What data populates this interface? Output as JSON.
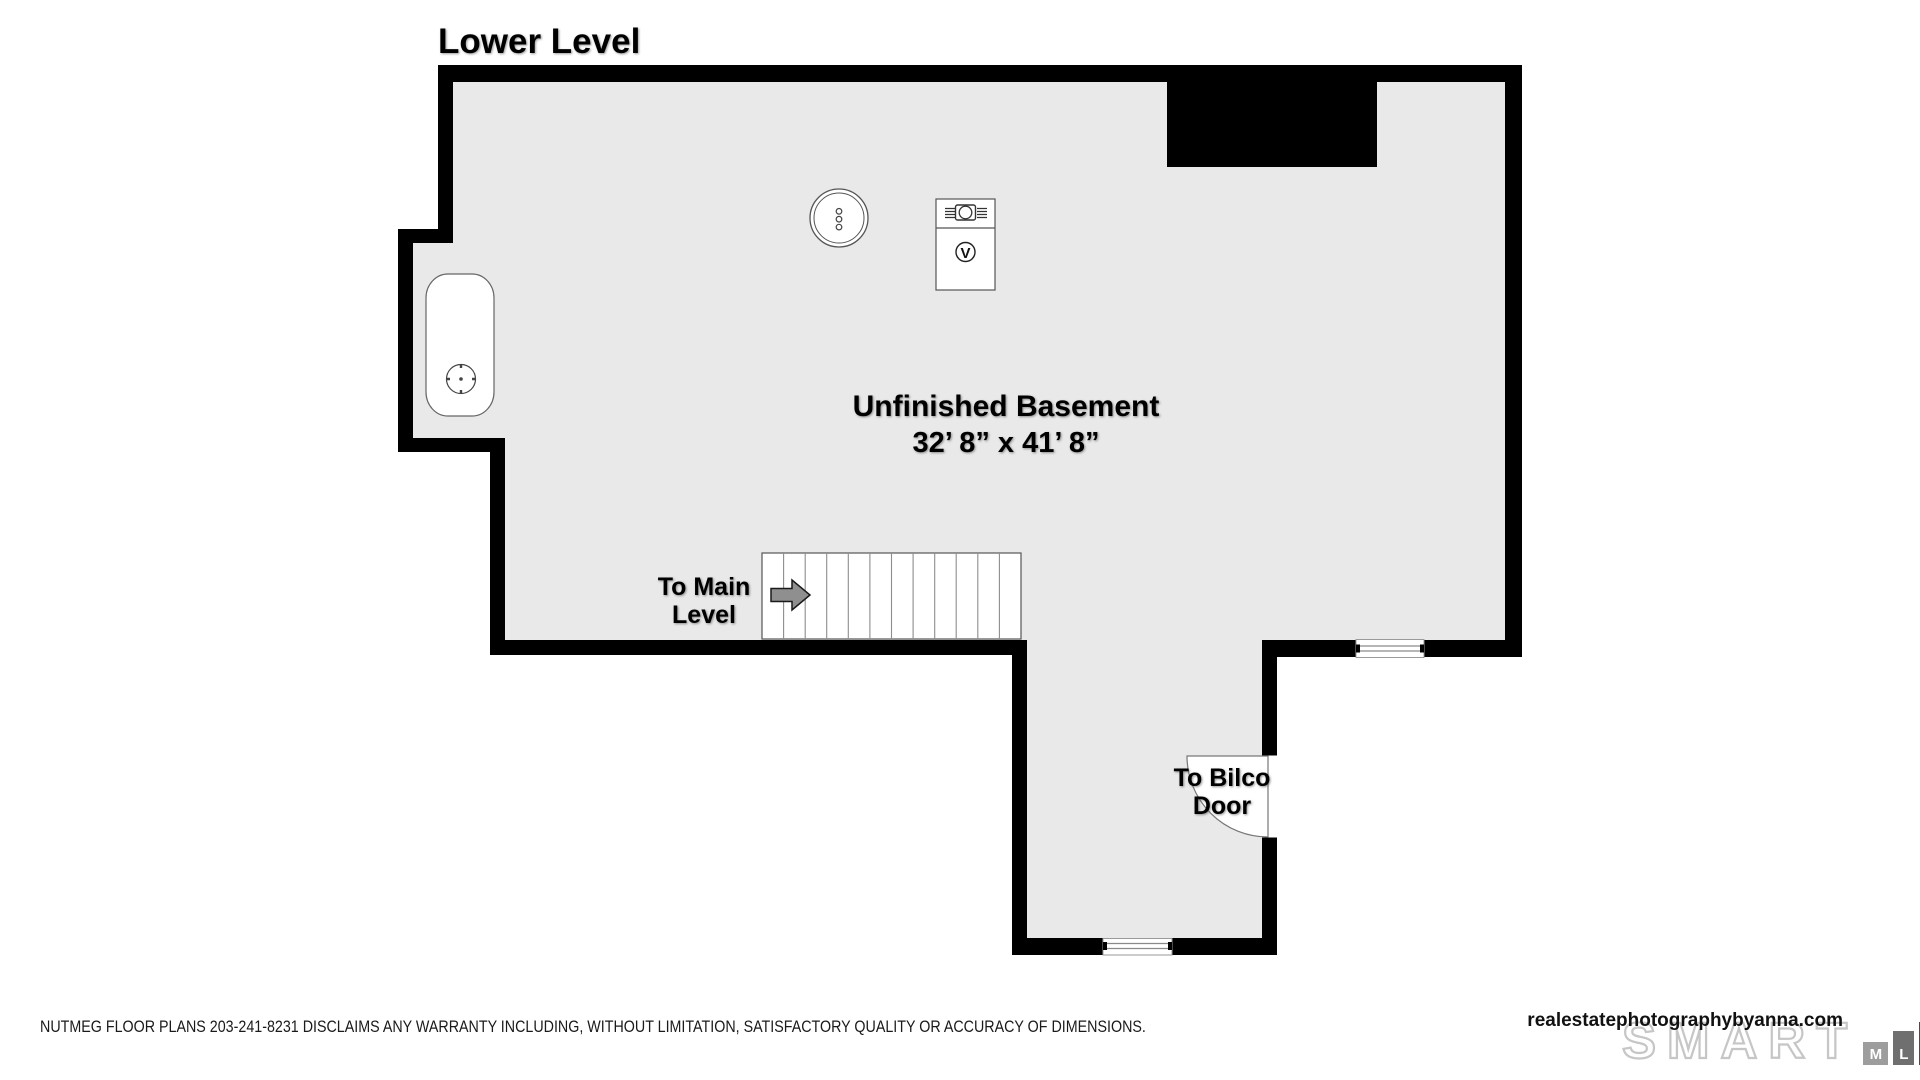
{
  "title": "Lower Level",
  "room": {
    "name": "Unfinished Basement",
    "dimensions": "32’ 8” x 41’ 8”"
  },
  "labels": {
    "stairs": {
      "line1": "To Main",
      "line2": "Level"
    },
    "bilco": {
      "line1": "To Bilco",
      "line2": "Door"
    }
  },
  "icons": {
    "furnace_glyph": "V"
  },
  "footer": {
    "disclaimer": "NUTMEG FLOOR PLANS 203-241-8231 DISCLAIMS ANY WARRANTY INCLUDING, WITHOUT LIMITATION, SATISFACTORY QUALITY OR ACCURACY OF DIMENSIONS.",
    "website": "realestatephotographybyanna.com",
    "logo": {
      "word": "SMART",
      "boxes": [
        "M",
        "L",
        "S"
      ]
    }
  },
  "colors": {
    "floor": "#e9e9e9",
    "wall": "#000000",
    "arrow": "#8f8f8f",
    "mls_m": "#9d9d9d",
    "mls_l": "#6f6f6f",
    "mls_s": "#4b4b4b"
  }
}
